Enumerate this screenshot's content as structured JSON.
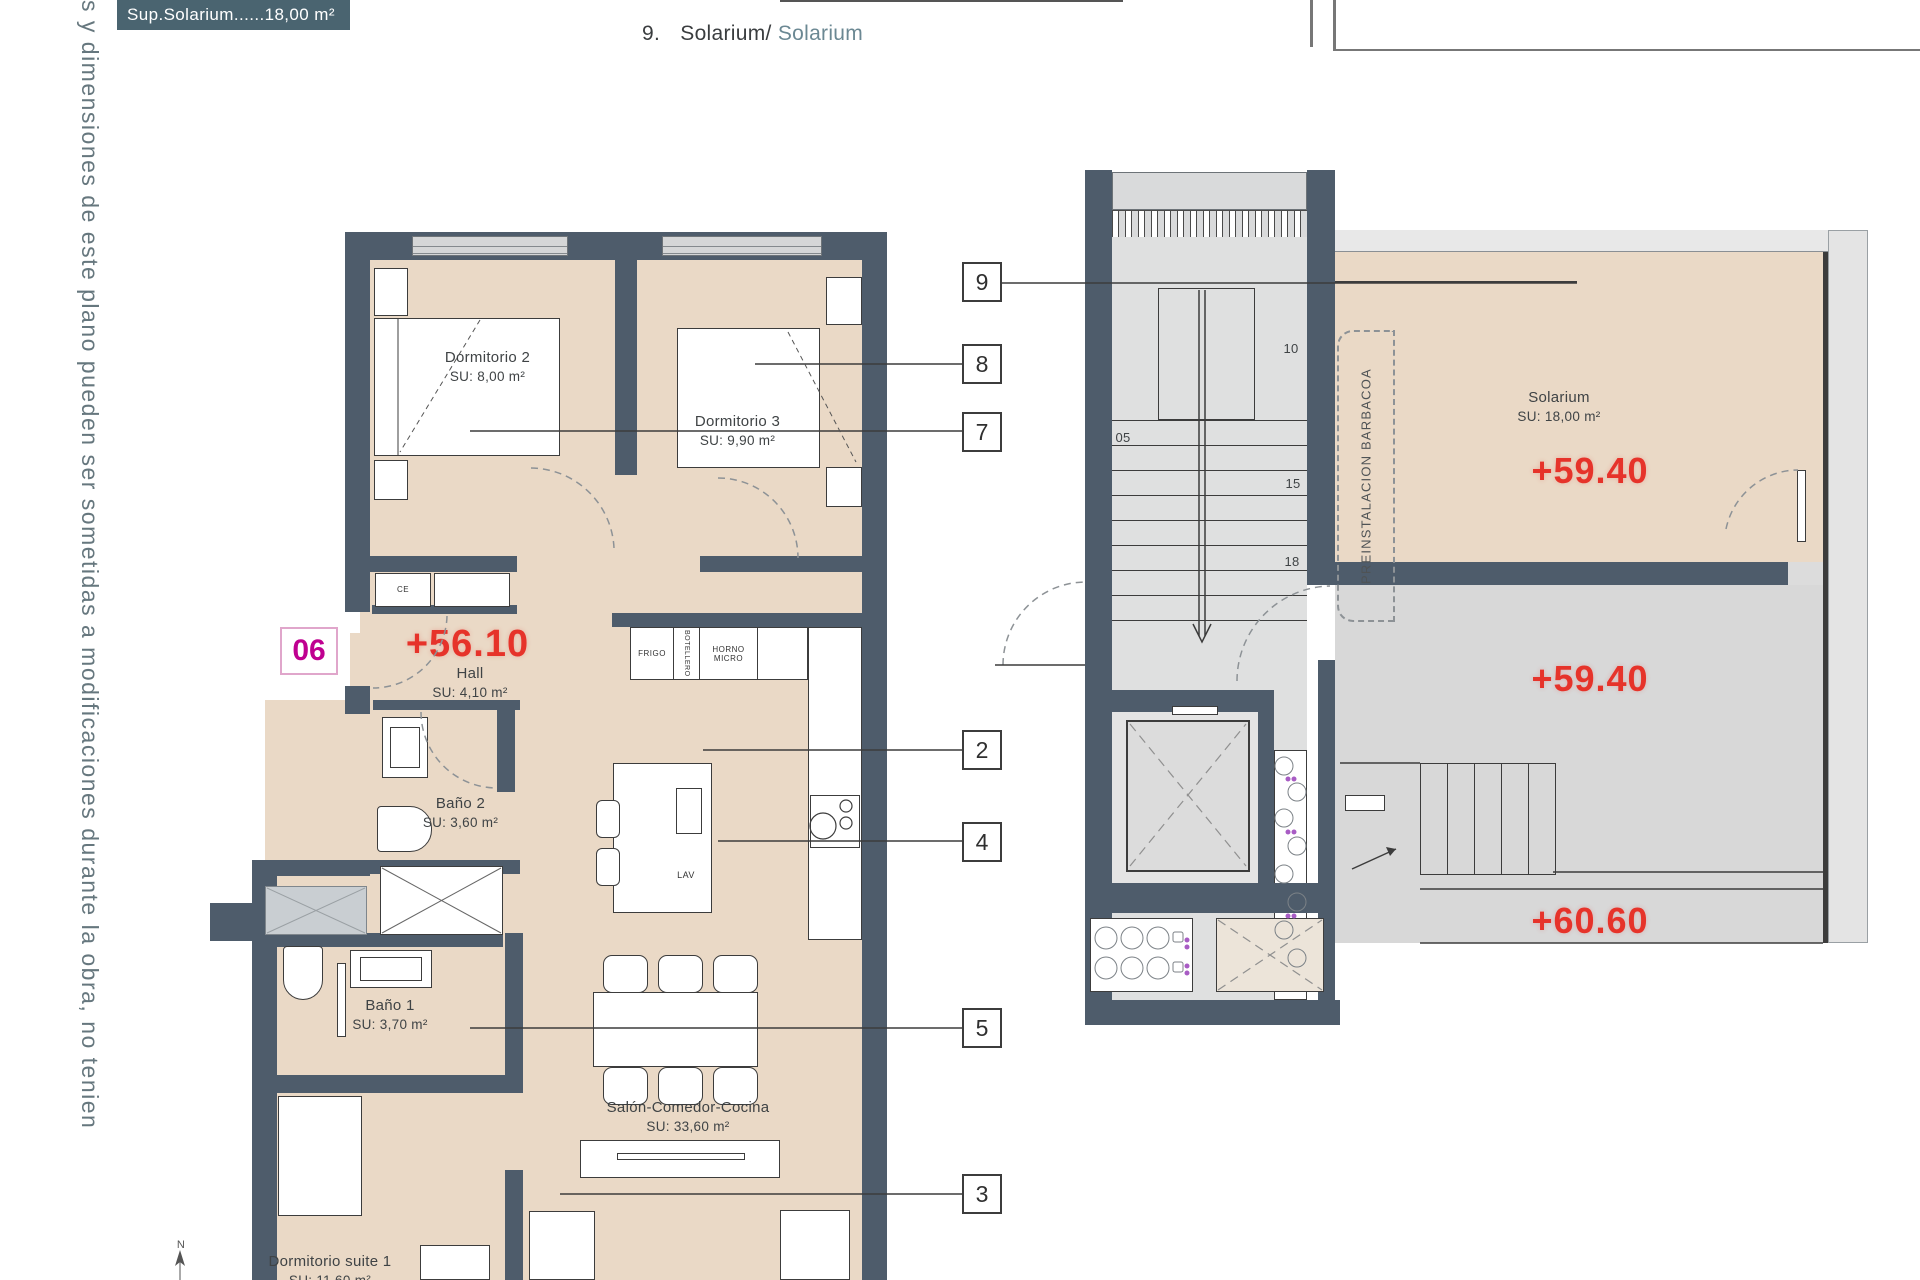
{
  "colors": {
    "wall": "#4e5c6b",
    "floor_beige": "#ead9c6",
    "floor_gray": "#d8d8d8",
    "stair_gray": "#dfe0e0",
    "accent_red": "#e6332a",
    "magenta": "#bf0090",
    "teal_box": "#4a6470",
    "teal_text": "#6b8893"
  },
  "header": {
    "legend": "Sup.Solarium......18,00 m²",
    "item_number": "9.",
    "item_label": "Solarium/",
    "item_label_alt": "Solarium"
  },
  "side_note": "s y dimensiones de este plano pueden ser sometidas a modificaciones durante la obra, no tenien",
  "unit_badge": "06",
  "levels": {
    "hall": "+56.10",
    "solarium": "+59.40",
    "terrace": "+59.40",
    "upper": "+60.60"
  },
  "rooms": {
    "dormitorio2": {
      "name": "Dormitorio 2",
      "area": "SU: 8,00 m²"
    },
    "dormitorio3": {
      "name": "Dormitorio 3",
      "area": "SU: 9,90 m²"
    },
    "hall": {
      "name": "Hall",
      "area": "SU: 4,10 m²"
    },
    "bano2": {
      "name": "Baño 2",
      "area": "SU: 3,60 m²"
    },
    "bano1": {
      "name": "Baño 1",
      "area": "SU: 3,70 m²"
    },
    "salon": {
      "name": "Salón-Comedor-Cocina",
      "area": "SU: 33,60 m²"
    },
    "suite": {
      "name": "Dormitorio suite 1",
      "area": "SU: 11,60 m²"
    },
    "solarium": {
      "name": "Solarium",
      "area": "SU: 18,00 m²"
    }
  },
  "kitchen": {
    "fridge": "FRIGO",
    "bottle_rack": "BOTELLERO",
    "oven": "HORNO",
    "micro": "MICRO",
    "wash": "LAV",
    "closet": "CE"
  },
  "callouts": {
    "c9": "9",
    "c8": "8",
    "c7": "7",
    "c2": "2",
    "c4": "4",
    "c5": "5",
    "c3": "3"
  },
  "stairs": {
    "s05": "05",
    "s10": "10",
    "s15": "15",
    "s18": "18"
  },
  "barbecue": {
    "line1": "PREINSTALACION",
    "line2": "BARBACOA"
  },
  "compass": "N"
}
